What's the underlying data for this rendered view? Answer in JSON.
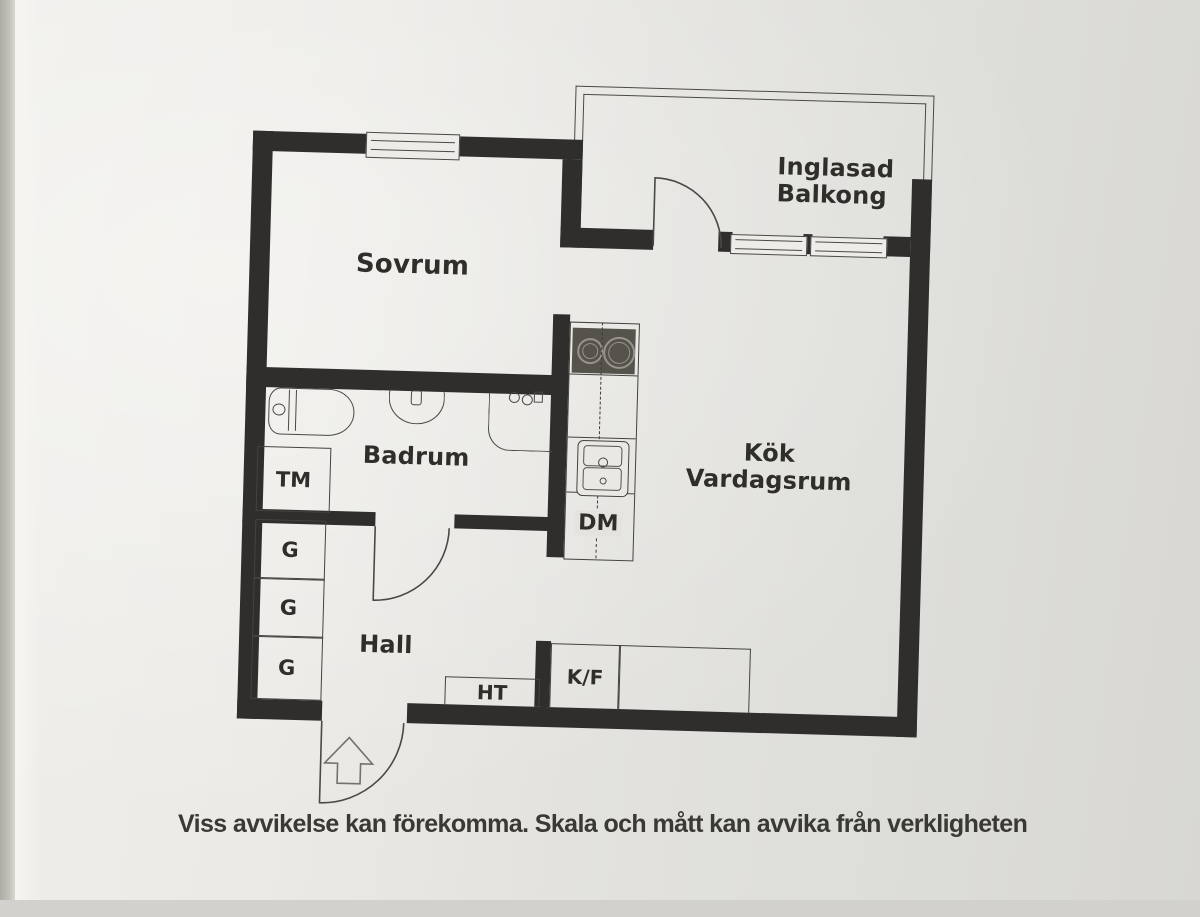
{
  "floorplan": {
    "rooms": {
      "sovrum": {
        "label": "Sovrum"
      },
      "inglasad_balkong": {
        "line1": "Inglasad",
        "line2": "Balkong"
      },
      "kok_vardagsrum": {
        "line1": "Kök",
        "line2": "Vardagsrum"
      },
      "badrum": {
        "label": "Badrum"
      },
      "hall": {
        "label": "Hall"
      }
    },
    "labels": {
      "tm": "TM",
      "g_top": "G",
      "g_middle": "G",
      "g_bottom": "G",
      "dm": "DM",
      "ht": "HT",
      "kf": "K/F"
    },
    "colors": {
      "wall": "#2f2e2c",
      "paper": "#e8e7e3",
      "thin_line": "#4a4946",
      "stove_fill": "#55534c",
      "text": "#2f2e2b"
    }
  },
  "caption": {
    "text": "Viss avvikelse kan förekomma. Skala och mått kan avvika från verkligheten"
  }
}
